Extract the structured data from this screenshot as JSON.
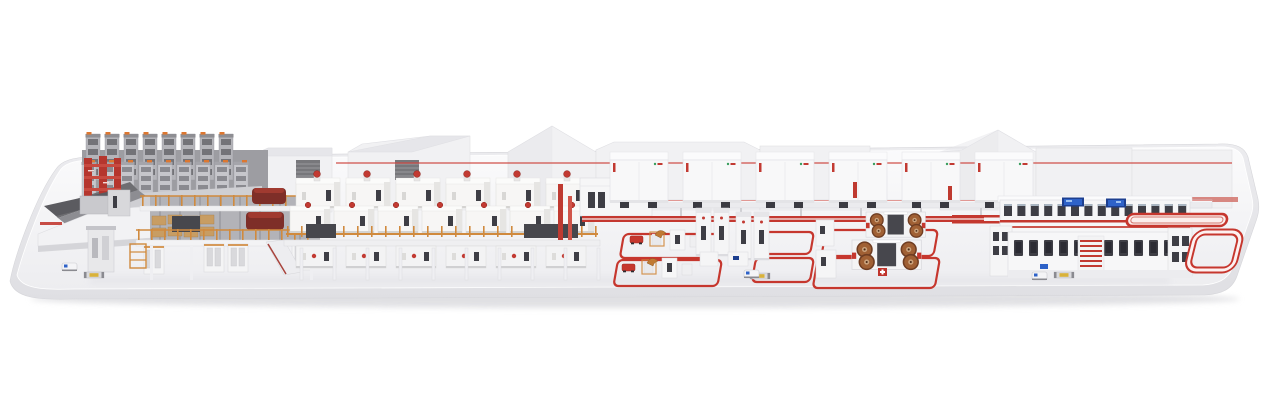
{
  "meta": {
    "description": "3D rendering of a complete turnkey industrial production line displayed on a long white platform with rounded corners: reel storage racks, corrugator mezzanine with orange scaffolding, a double-deck process line, rows of white process cabinets, robot handling cells and coil winding cells enclosed by red floor conveyor loops, a two-story finishing line with blue control screens, red racetrack conveyors at the line end, and small AGV shuttles."
  },
  "palette": {
    "background": "#ffffff",
    "platform_top_light": "#fbfbfc",
    "platform_top_dark": "#ededf0",
    "platform_front_light": "#ececef",
    "platform_front_dark": "#dfdfe3",
    "platform_shadow": "#d9d9dd",
    "building": "#f1f1f3",
    "building_line": "#dfdfe3",
    "rack_gray": "#b4b4b9",
    "rack_dark": "#737378",
    "machine_white": "#f7f6f5",
    "machine_shade": "#e6e5e3",
    "window_dark": "#3e3e45",
    "accent_red": "#c23a32",
    "accent_red_dark": "#9e2a24",
    "loop_red": "#c6372e",
    "scaffold_orange": "#d08a3e",
    "board_tan": "#c89d63",
    "coil_copper": "#a06034",
    "coil_ring": "#6f3d22",
    "screen_blue": "#2e62c8",
    "screen_navy": "#1d3f8f",
    "pallet_yellow": "#d9b23a",
    "charcoal": "#47474d"
  },
  "scene": {
    "sections": [
      {
        "id": "reel-storage",
        "label": "Reel storage racks",
        "towers_back": 8,
        "towers_front": 9
      },
      {
        "id": "red-tower",
        "label": "Red service tower"
      },
      {
        "id": "splice-table",
        "label": "Splicing table with web feed"
      },
      {
        "id": "corrugator-mezzanine",
        "label": "Corrugator mezzanine with orange scaffolding",
        "rail_posts": 14
      },
      {
        "id": "double-deck-line",
        "label": "Double-deck process line",
        "upper_units": 6,
        "mid_units": 7,
        "lower_units": 6,
        "legs": 10,
        "rail_posts": 23
      },
      {
        "id": "control-cabinets",
        "label": "Control cabinet cluster"
      },
      {
        "id": "oven-cabinets",
        "label": "Process cabinet row",
        "units": 6
      },
      {
        "id": "robot-cells",
        "label": "Robot handling cells with red floor loops",
        "loops": 2
      },
      {
        "id": "stacker-towers",
        "label": "Stacker towers",
        "towers": 4
      },
      {
        "id": "coil-cells",
        "label": "Coil winding cells with red floor loops",
        "loops": 2,
        "coils_per_machine": 4
      },
      {
        "id": "finishing-line",
        "label": "Two-story finishing line with control screens",
        "upper_windows": 14,
        "lower_windows": 12,
        "louvers": 6
      },
      {
        "id": "red-conveyor-loops",
        "label": "Red racetrack conveyor loops"
      },
      {
        "id": "agv",
        "label": "AGV shuttles",
        "count": 3
      }
    ]
  }
}
